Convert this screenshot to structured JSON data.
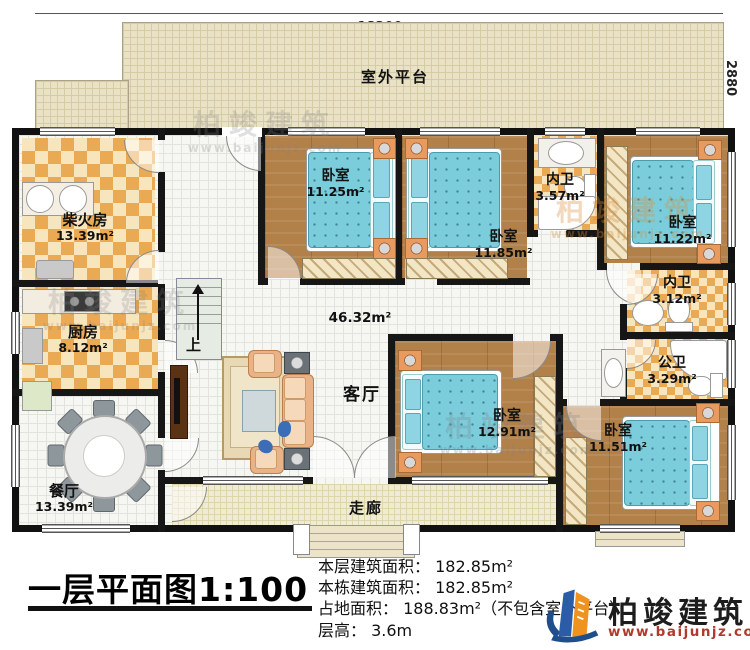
{
  "plan": {
    "title": "一层平面图1:100",
    "dims": {
      "top": "18200",
      "right_upper": "2880",
      "right_lower": "10000"
    },
    "rooms": {
      "platform": {
        "name": "室外平台",
        "area": ""
      },
      "firewood": {
        "name": "柴火房",
        "area": "13.39m²"
      },
      "kitchen": {
        "name": "厨房",
        "area": "8.12m²"
      },
      "dining": {
        "name": "餐厅",
        "area": "13.39m²"
      },
      "living": {
        "name": "客厅",
        "area": "46.32m²"
      },
      "bedroom1": {
        "name": "卧室",
        "area": "11.25m²"
      },
      "bedroom2": {
        "name": "卧室",
        "area": "11.85m²"
      },
      "bedroom3": {
        "name": "卧室",
        "area": "11.22m²"
      },
      "bedroom4": {
        "name": "卧室",
        "area": "12.91m²"
      },
      "bedroom5": {
        "name": "卧室",
        "area": "11.51m²"
      },
      "ensuite1": {
        "name": "内卫",
        "area": "3.57m²"
      },
      "ensuite2": {
        "name": "内卫",
        "area": "3.12m²"
      },
      "publicbath": {
        "name": "公卫",
        "area": "3.29m²"
      },
      "corridor": {
        "name": "走廊",
        "area": ""
      }
    },
    "stairs": {
      "label": "上"
    },
    "info": {
      "line1": "本层建筑面积： 182.85m²",
      "line2": "本栋建筑面积： 182.85m²",
      "line3": "占地面积： 188.83m²（不包含室外平台）",
      "line4": "层高： 3.6m"
    },
    "logo": {
      "brand": "柏竣建筑",
      "url": "www.baijunjz.com"
    },
    "watermark": {
      "brand": "柏竣建筑",
      "url": "www.baijunjz.com"
    },
    "colors": {
      "accent_orange": "#f0921e",
      "accent_blue": "#2a5ca8",
      "url_red": "#b03a2e"
    }
  }
}
